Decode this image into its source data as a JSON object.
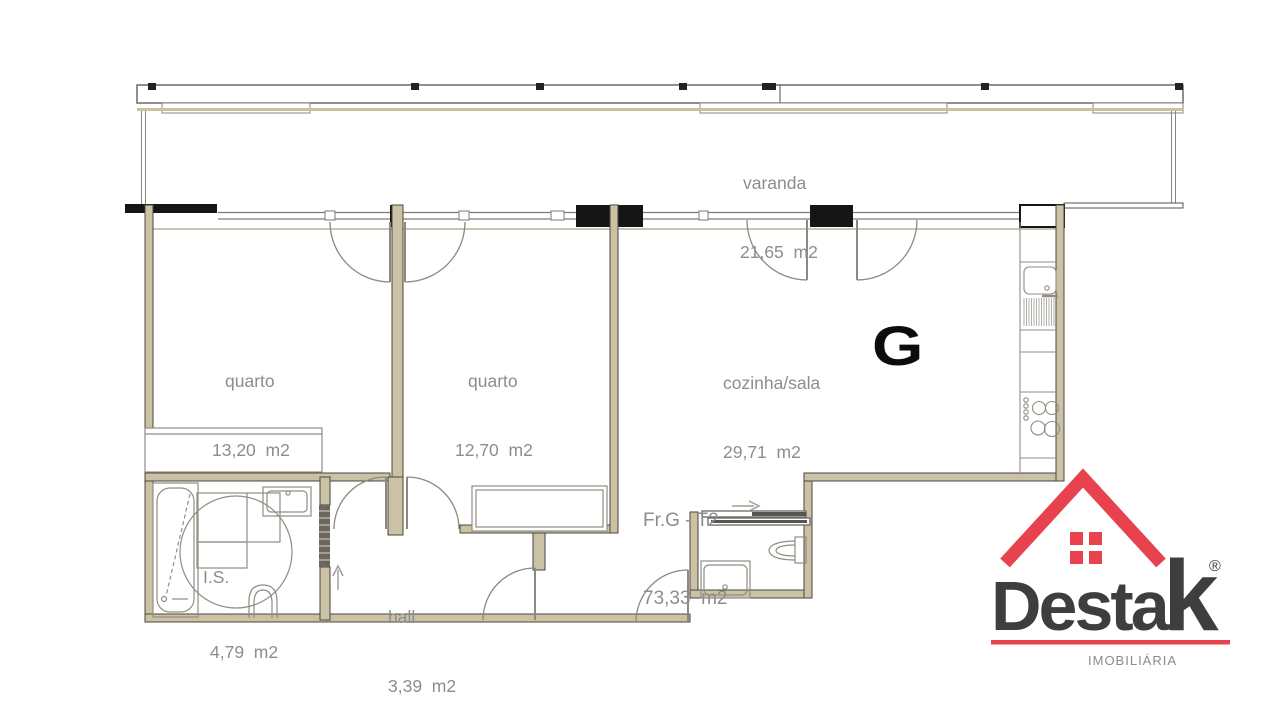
{
  "plan": {
    "rooms": [
      {
        "name": "varanda",
        "area": "21,65  m2"
      },
      {
        "name": "quarto",
        "area": "13,20  m2"
      },
      {
        "name": "quarto",
        "area": "12,70  m2"
      },
      {
        "name": "cozinha/sala",
        "area": "29,71  m2"
      },
      {
        "name": "Fr.G - T2",
        "area": "73,33  m2"
      },
      {
        "name": "I.S.",
        "area": "4,79  m2"
      },
      {
        "name": "hall",
        "area": "3,39  m2"
      }
    ],
    "garage_label": "G"
  },
  "logo": {
    "brand": "Desta",
    "brand_k": "k",
    "registered": "®",
    "tagline": "IMOBILIÁRIA",
    "red": "#e8424e",
    "dark": "#3e3e40",
    "gray": "#8b8b8b"
  },
  "colors": {
    "wall_fill": "#cbc2a5",
    "wall_stroke": "#4a463f",
    "pier_black": "#151515",
    "fixture_gray": "#918d84",
    "label_gray": "#8d8d8d"
  }
}
